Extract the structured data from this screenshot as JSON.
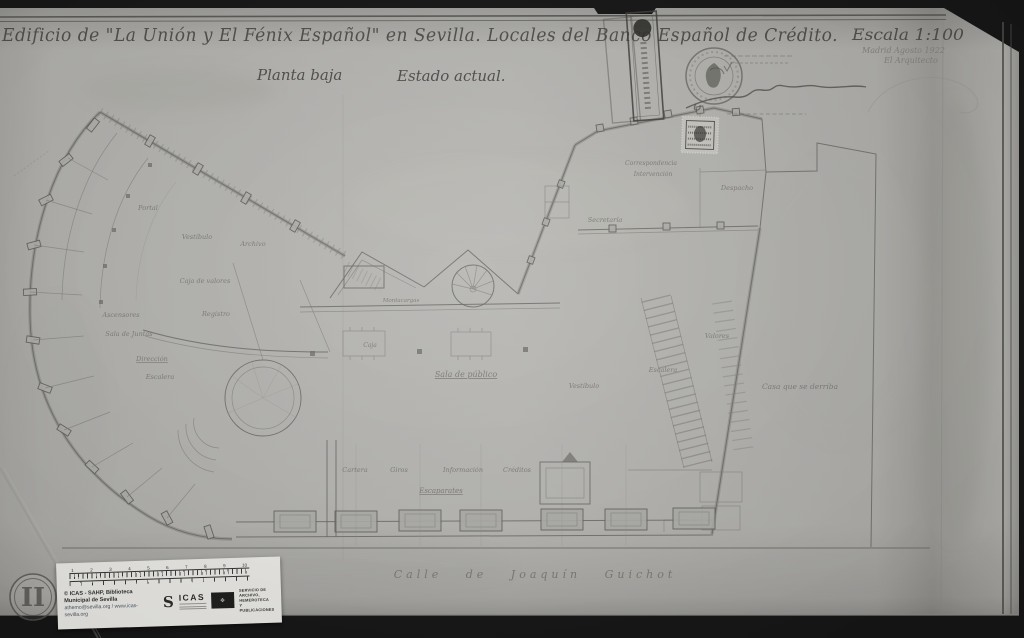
{
  "document": {
    "title": "Edificio de \"La Unión y El Fénix Español\" en Sevilla. Locales del Banco Español de Crédito.",
    "subtitle_plan": "Planta baja",
    "subtitle_state": "Estado actual.",
    "scale": "Escala 1:100",
    "place_date": "Madrid Agosto 1922",
    "signatory": "El Arquitecto",
    "folio_mark": "II"
  },
  "plan": {
    "street_label": "Calle de Joaquín Guichot",
    "rooms": [
      {
        "label": "Portal",
        "x": 148,
        "y": 210
      },
      {
        "label": "Vestíbulo",
        "x": 197,
        "y": 239
      },
      {
        "label": "Archivo",
        "x": 253,
        "y": 246
      },
      {
        "label": "Caja de valores",
        "x": 205,
        "y": 283
      },
      {
        "label": "Ascensores",
        "x": 121,
        "y": 317
      },
      {
        "label": "Sala de Juntas",
        "x": 129,
        "y": 336
      },
      {
        "label": "Dirección",
        "x": 152,
        "y": 361,
        "underline": true
      },
      {
        "label": "Escalera",
        "x": 160,
        "y": 379
      },
      {
        "label": "Registro",
        "x": 216,
        "y": 316
      },
      {
        "label": "Montacargas",
        "x": 401,
        "y": 302,
        "size": 5.5
      },
      {
        "label": "Caja",
        "x": 370,
        "y": 347,
        "size": 6
      },
      {
        "label": "Sala de público",
        "x": 466,
        "y": 377,
        "underline": true,
        "size": 8
      },
      {
        "label": "Vestíbulo",
        "x": 584,
        "y": 388
      },
      {
        "label": "Correspondencia",
        "x": 651,
        "y": 165,
        "size": 6
      },
      {
        "label": "Intervención",
        "x": 653,
        "y": 176,
        "size": 6
      },
      {
        "label": "Secretaría",
        "x": 605,
        "y": 222
      },
      {
        "label": "Despacho",
        "x": 737,
        "y": 190
      },
      {
        "label": "Valores",
        "x": 717,
        "y": 338
      },
      {
        "label": "Escalera",
        "x": 663,
        "y": 372
      },
      {
        "label": "Cartera",
        "x": 355,
        "y": 472
      },
      {
        "label": "Giros",
        "x": 399,
        "y": 472
      },
      {
        "label": "Información",
        "x": 463,
        "y": 472
      },
      {
        "label": "Créditos",
        "x": 517,
        "y": 472
      },
      {
        "label": "Escaparates",
        "x": 441,
        "y": 493,
        "underline": true,
        "size": 7
      },
      {
        "label": "Casa que se derriba",
        "x": 800,
        "y": 389,
        "size": 7.5
      }
    ]
  },
  "archive_label": {
    "copyright": "© ICAS - SAHP, Biblioteca Municipal de Sevilla",
    "contact": "athemo@sevilla.org / www.icas-sevilla.org",
    "logo_mark": "S",
    "logo_text": "ICAS",
    "service_lines": [
      "SERVICIO DE",
      "ARCHIVO,",
      "HEMEROTECA",
      "Y PUBLICACIONES"
    ],
    "ruler_numbers": [
      "1",
      "2",
      "3",
      "4",
      "5",
      "6",
      "7",
      "8",
      "9",
      "10"
    ]
  },
  "colors": {
    "paper": "#b7b6b2",
    "ink": "#504f4c",
    "pencil": "#7b7a75",
    "scan_bed": "#161616",
    "label_bg": "#edece8"
  }
}
